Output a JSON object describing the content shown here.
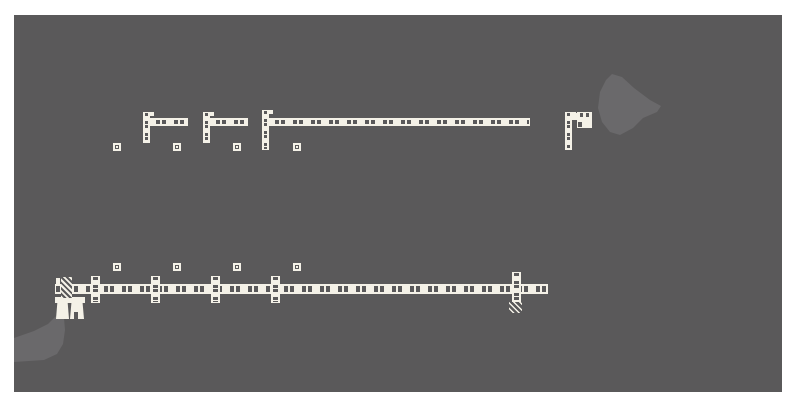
{
  "meta": {
    "description": "Plan-view architectural drawing: cream framed wall segments with dash-dot cavities, corner assemblies, post markers, hatched end details and two lighter terrain blobs on a dark gray drawing canvas with white page margins."
  },
  "colors": {
    "page_bg": "#ffffff",
    "canvas_bg": "#5a595a",
    "terrain": "#6a696b",
    "wall": "#f4f1e7"
  },
  "canvas": {
    "x": 14,
    "y": 15,
    "w": 768,
    "h": 377
  },
  "plan": {
    "h_walls": [
      {
        "name": "upper-corner1-wall-horizontal",
        "x": 143,
        "y": 118,
        "w": 45,
        "h": 8
      },
      {
        "name": "upper-corner2-wall-horizontal",
        "x": 203,
        "y": 118,
        "w": 45,
        "h": 8
      },
      {
        "name": "upper-main-wall",
        "x": 262,
        "y": 118,
        "w": 268,
        "h": 8
      },
      {
        "name": "upper-right-stub-horizontal",
        "x": 565,
        "y": 113,
        "w": 14,
        "h": 7
      },
      {
        "name": "lower-main-wall",
        "x": 55,
        "y": 284,
        "w": 493,
        "h": 10
      }
    ],
    "v_walls": [
      {
        "name": "upper-corner1-wall-vertical",
        "x": 143,
        "y": 112,
        "w": 7,
        "h": 31
      },
      {
        "name": "upper-corner2-wall-vertical",
        "x": 203,
        "y": 112,
        "w": 7,
        "h": 31
      },
      {
        "name": "upper-main-wall-vertical",
        "x": 262,
        "y": 110,
        "w": 7,
        "h": 40
      },
      {
        "name": "upper-right-wall-vertical",
        "x": 565,
        "y": 112,
        "w": 7,
        "h": 38
      },
      {
        "name": "lower-stud-stub-1",
        "x": 91,
        "y": 276,
        "w": 9,
        "h": 27
      },
      {
        "name": "lower-stud-stub-2",
        "x": 151,
        "y": 276,
        "w": 9,
        "h": 27
      },
      {
        "name": "lower-stud-stub-3",
        "x": 211,
        "y": 276,
        "w": 9,
        "h": 27
      },
      {
        "name": "lower-stud-stub-4",
        "x": 271,
        "y": 276,
        "w": 9,
        "h": 27
      },
      {
        "name": "lower-right-end-stub",
        "x": 512,
        "y": 272,
        "w": 9,
        "h": 30
      }
    ],
    "posts": [
      {
        "name": "post-marker-upper-1",
        "x": 113,
        "y": 143
      },
      {
        "name": "post-marker-upper-2",
        "x": 173,
        "y": 143
      },
      {
        "name": "post-marker-upper-3",
        "x": 233,
        "y": 143
      },
      {
        "name": "post-marker-upper-4",
        "x": 293,
        "y": 143
      },
      {
        "name": "post-marker-lower-1",
        "x": 113,
        "y": 263
      },
      {
        "name": "post-marker-lower-2",
        "x": 173,
        "y": 263
      },
      {
        "name": "post-marker-lower-3",
        "x": 233,
        "y": 263
      },
      {
        "name": "post-marker-lower-4",
        "x": 293,
        "y": 263
      }
    ],
    "ticks": [
      {
        "name": "corner-tick-1",
        "x": 150,
        "y": 112,
        "w": 4,
        "h": 4
      },
      {
        "name": "corner-tick-2",
        "x": 210,
        "y": 112,
        "w": 4,
        "h": 4
      },
      {
        "name": "corner-tick-3",
        "x": 269,
        "y": 110,
        "w": 4,
        "h": 4
      },
      {
        "name": "corner-tick-right",
        "x": 572,
        "y": 112,
        "w": 4,
        "h": 4
      },
      {
        "name": "lower-left-end-tick",
        "x": 56,
        "y": 278,
        "w": 4,
        "h": 7
      }
    ],
    "solids": [
      {
        "name": "upper-right-filled-block",
        "x": 577,
        "y": 112,
        "w": 15,
        "h": 16,
        "trap": false
      },
      {
        "name": "lower-left-strip",
        "x": 55,
        "y": 297,
        "w": 30,
        "h": 6,
        "trap": false
      },
      {
        "name": "lower-left-block-a",
        "x": 56,
        "y": 303,
        "w": 13,
        "h": 16,
        "trap": true
      },
      {
        "name": "lower-left-block-b",
        "x": 70,
        "y": 303,
        "w": 14,
        "h": 16,
        "trap": true
      }
    ],
    "marks": [
      {
        "name": "filled-block-notch-1",
        "x": 580,
        "y": 113,
        "w": 3,
        "h": 4
      },
      {
        "name": "filled-block-notch-2",
        "x": 586,
        "y": 113,
        "w": 3,
        "h": 4
      },
      {
        "name": "filled-block-notch-3",
        "x": 578,
        "y": 122,
        "w": 4,
        "h": 5
      },
      {
        "name": "block-b-notch",
        "x": 74,
        "y": 312,
        "w": 4,
        "h": 7
      }
    ],
    "hatches": [
      {
        "name": "lower-left-hatched-stub",
        "x": 61,
        "y": 277,
        "w": 11,
        "h": 21,
        "cls": "hatch-solid"
      },
      {
        "name": "lower-right-hatch-mark",
        "x": 509,
        "y": 301,
        "w": 13,
        "h": 12,
        "cls": "hatch-lines"
      }
    ],
    "terrain_blobs": [
      {
        "name": "terrain-blob-top-right",
        "points": "612,74 622,77 634,88 650,100 661,106 657,112 643,118 633,128 620,135 610,132 602,122 598,108 600,92 606,80"
      },
      {
        "name": "terrain-blob-bottom-left",
        "points": "14,338 34,331 48,324 55,317 60,314 64,318 65,330 63,344 57,354 44,360 14,362"
      }
    ]
  }
}
